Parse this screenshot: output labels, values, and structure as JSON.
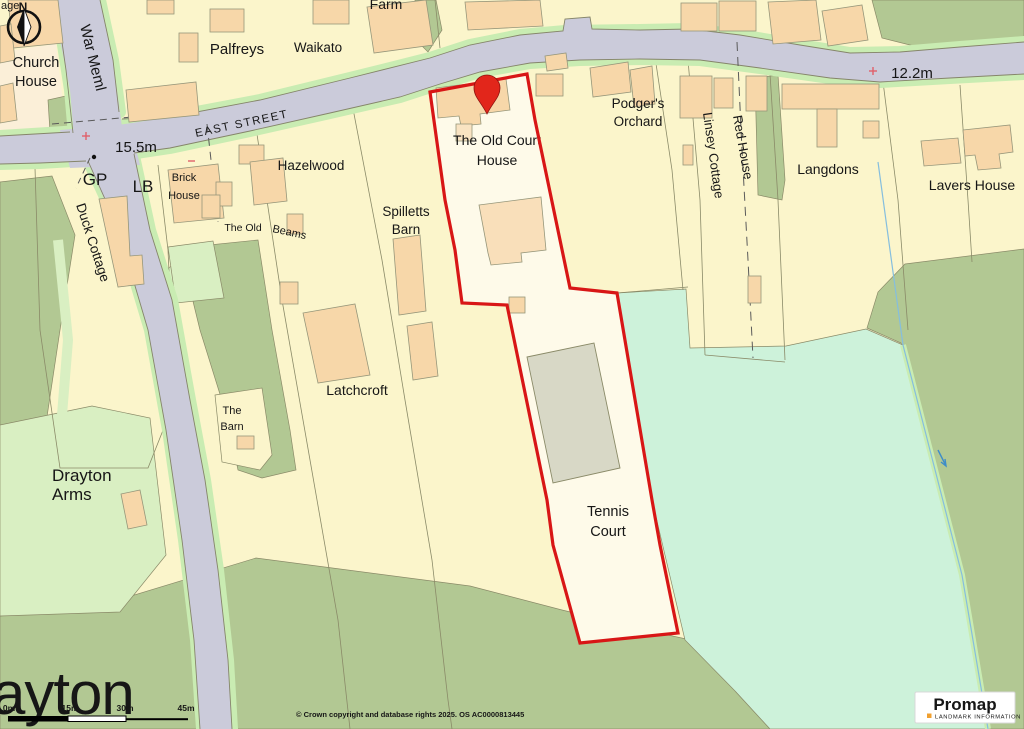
{
  "map": {
    "cut_label": "age",
    "compass_n": "N",
    "street": "EAST STREET",
    "spot_heights": {
      "junction": "15.5m",
      "east": "12.2m"
    },
    "labels": {
      "church_house": [
        "Church",
        "House"
      ],
      "war_meml": "War Meml",
      "palfreys": "Palfreys",
      "waikato": "Waikato",
      "farm": "Farm",
      "gp": "GP",
      "lb": "LB",
      "brick_house": [
        "Brick",
        "House"
      ],
      "hazelwood": "Hazelwood",
      "the_old": "The Old",
      "beams": "Beams",
      "duck_cottage": "Duck Cottage",
      "spilletts_barn": [
        "Spilletts",
        "Barn"
      ],
      "old_court_house": [
        "The Old Court",
        "House"
      ],
      "podgers_orchard": [
        "Podger's",
        "Orchard"
      ],
      "linsey_cottage": "Linsey Cottage",
      "red_house": "Red House",
      "langdons": "Langdons",
      "lavers_house": "Lavers House",
      "latchcroft": "Latchcroft",
      "the_barn": [
        "The",
        "Barn"
      ],
      "drayton_arms": [
        "Drayton",
        "Arms"
      ],
      "tennis_court": [
        "Tennis",
        "Court"
      ]
    },
    "icons": {
      "compass": "north-arrow",
      "marker": "location-pin",
      "spot_symbol": "red-cross"
    },
    "footer": {
      "partial_title": "ayton",
      "scale_ticks": [
        "0m",
        "15m",
        "30m",
        "45m"
      ],
      "copyright": "© Crown copyright and database rights 2025. OS AC0000813445"
    },
    "logo": {
      "brand": "Promap",
      "tagline": "LANDMARK INFORMATION"
    },
    "colors": {
      "parcel_yellow": "#FBF5CB",
      "plot_fill": "#FEFAE9",
      "road_gray": "#CBCBDA",
      "verge_green": "#C9ECB2",
      "woodland_sage": "#B2C893",
      "grass_light": "#D9EFC2",
      "meadow_mint": "#CDF2DA",
      "building_peach": "#F7D7A9",
      "court_gray": "#D8D8C6",
      "boundary_red": "#D81616",
      "line_olive": "#8A8A68"
    }
  }
}
